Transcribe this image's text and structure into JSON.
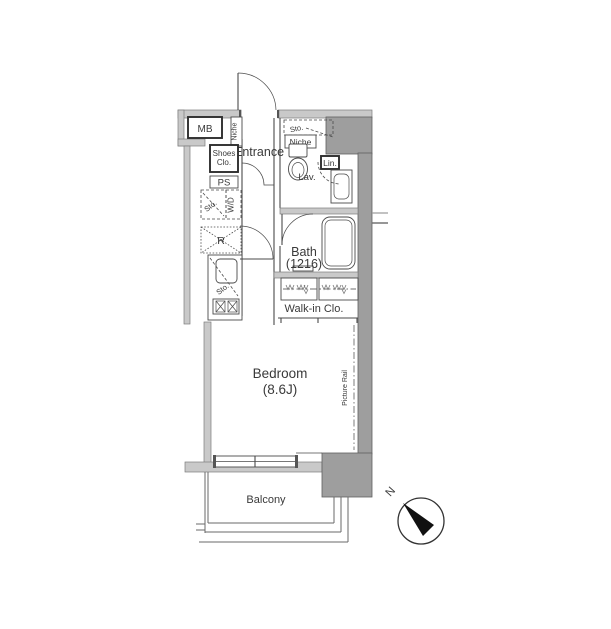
{
  "plan": {
    "labels": {
      "mb": "MB",
      "niche_entrance": "Niche",
      "entrance": "Entrance",
      "shoes_line1": "Shoes",
      "shoes_line2": "Clo.",
      "ps": "PS",
      "sto_laundry": "Sto.",
      "wd": "W/D",
      "fridge": "R",
      "sto_kitchen": "Sto.",
      "sto_toilet": "Sto.",
      "niche_toilet": "Niche",
      "lin": "Lin.",
      "lav": "Lav.",
      "bath_name": "Bath",
      "bath_size": "(1216)",
      "walkin": "Walk-in Clo.",
      "bedroom_name": "Bedroom",
      "bedroom_size": "(8.6J)",
      "picture_rail": "Picture Rail",
      "balcony": "Balcony",
      "compass_north": "N"
    },
    "colors": {
      "wall": "#c9c9c9",
      "shaft": "#9e9e9e",
      "line": "#4a4a4a",
      "text": "#3a3a3a",
      "needle": "#111111"
    }
  }
}
